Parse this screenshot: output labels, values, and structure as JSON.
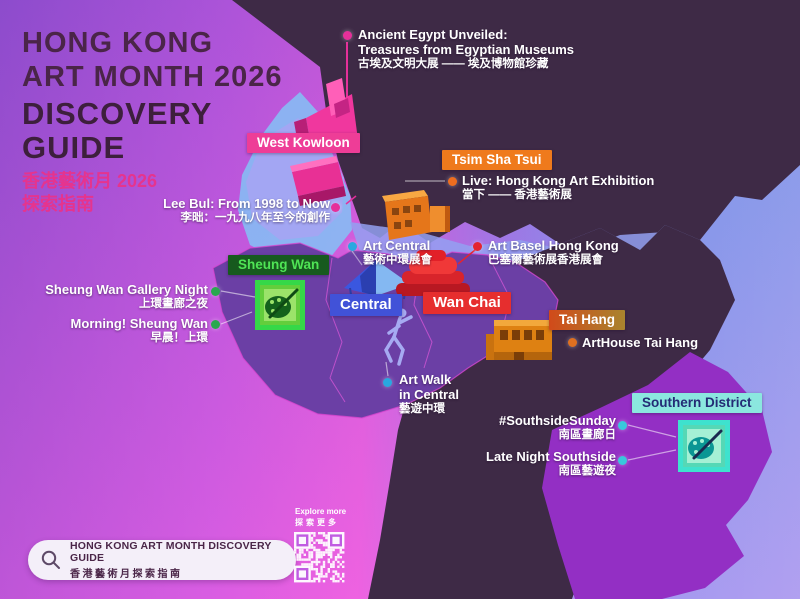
{
  "title": {
    "en_line1": "HONG KONG",
    "en_line2": "ART MONTH 2026",
    "dg_line1": "DISCOVERY",
    "dg_line2": "GUIDE",
    "zh_line1": "香港藝術月 2026",
    "zh_line2": "探索指南"
  },
  "districts": [
    {
      "label": "West Kowloon",
      "bg": "#EE3D97",
      "fg": "#FFFFFF"
    },
    {
      "label": "Tsim Sha Tsui",
      "bg": "#EF7A1C",
      "fg": "#FFFFFF"
    },
    {
      "label": "Sheung Wan",
      "bg": "#175A1E",
      "fg": "#4FE455"
    },
    {
      "label": "Central",
      "bg": "#4152D8",
      "fg": "#FFFFFF"
    },
    {
      "label": "Wan Chai",
      "bg": "#E62E2E",
      "fg": "#FFFFFF"
    },
    {
      "label": "Tai Hang",
      "bg": "linear-gradient(90deg,#D14A1A,#A9842E)",
      "fg": "#FFFFFF"
    },
    {
      "label": "Southern District",
      "bg": "#8BE7DF",
      "fg": "#232B75"
    }
  ],
  "events": [
    {
      "en": "Ancient Egypt Unveiled:",
      "en2": "Treasures from Egyptian Museums",
      "zh": "古埃及文明大展 —— 埃及博物館珍藏",
      "dot": "#E5309A"
    },
    {
      "en": "Lee Bul: From 1998 to Now",
      "zh": "李昢：一九九八年至今的創作",
      "dot": "#E5309A"
    },
    {
      "en": "Live: Hong Kong Art Exhibition",
      "zh": "當下 —— 香港藝術展",
      "dot": "#EE6D1F"
    },
    {
      "en": "Art Central",
      "zh": "藝術中環展會",
      "dot": "#29A8E0"
    },
    {
      "en": "Art Basel Hong Kong",
      "zh": "巴塞爾藝術展香港展會",
      "dot": "#E42430"
    },
    {
      "en": "Sheung Wan Gallery Night",
      "zh": "上環畫廊之夜",
      "dot": "#2AA84F"
    },
    {
      "en": "Morning! Sheung Wan",
      "zh": "早晨！上環",
      "dot": "#2AA84F"
    },
    {
      "en": "Art Walk",
      "en2": "in Central",
      "zh": "藝遊中環",
      "dot": "#29A8E0"
    },
    {
      "en": "ArtHouse Tai Hang",
      "dot": "#E07020"
    },
    {
      "en": "#SouthsideSunday",
      "zh": "南區畫廊日",
      "dot": "#38C8DC"
    },
    {
      "en": "Late Night Southside",
      "zh": "南區藝遊夜",
      "dot": "#38C8DC"
    }
  ],
  "footer": {
    "search_en": "HONG KONG ART MONTH DISCOVERY GUIDE",
    "search_zh": "香港藝術月探索指南",
    "explore_en": "Explore more",
    "explore_zh": "探索更多"
  },
  "colors": {
    "bg_purple": "#9A52CE",
    "bg_magenta": "#E866DE",
    "bg_blue": "#6FB7F3",
    "land_kowloon": "#3E2A46",
    "island_west": "#6B3FA5",
    "island_east": "#3E2A46",
    "southern_purple": "#932FC4",
    "west_kowloon_land": "#A3A6F3",
    "water": "#86BDF4",
    "boundary_pink": "#E058DC",
    "title_dark": "#4A2548",
    "title_pink": "#E5348E"
  }
}
